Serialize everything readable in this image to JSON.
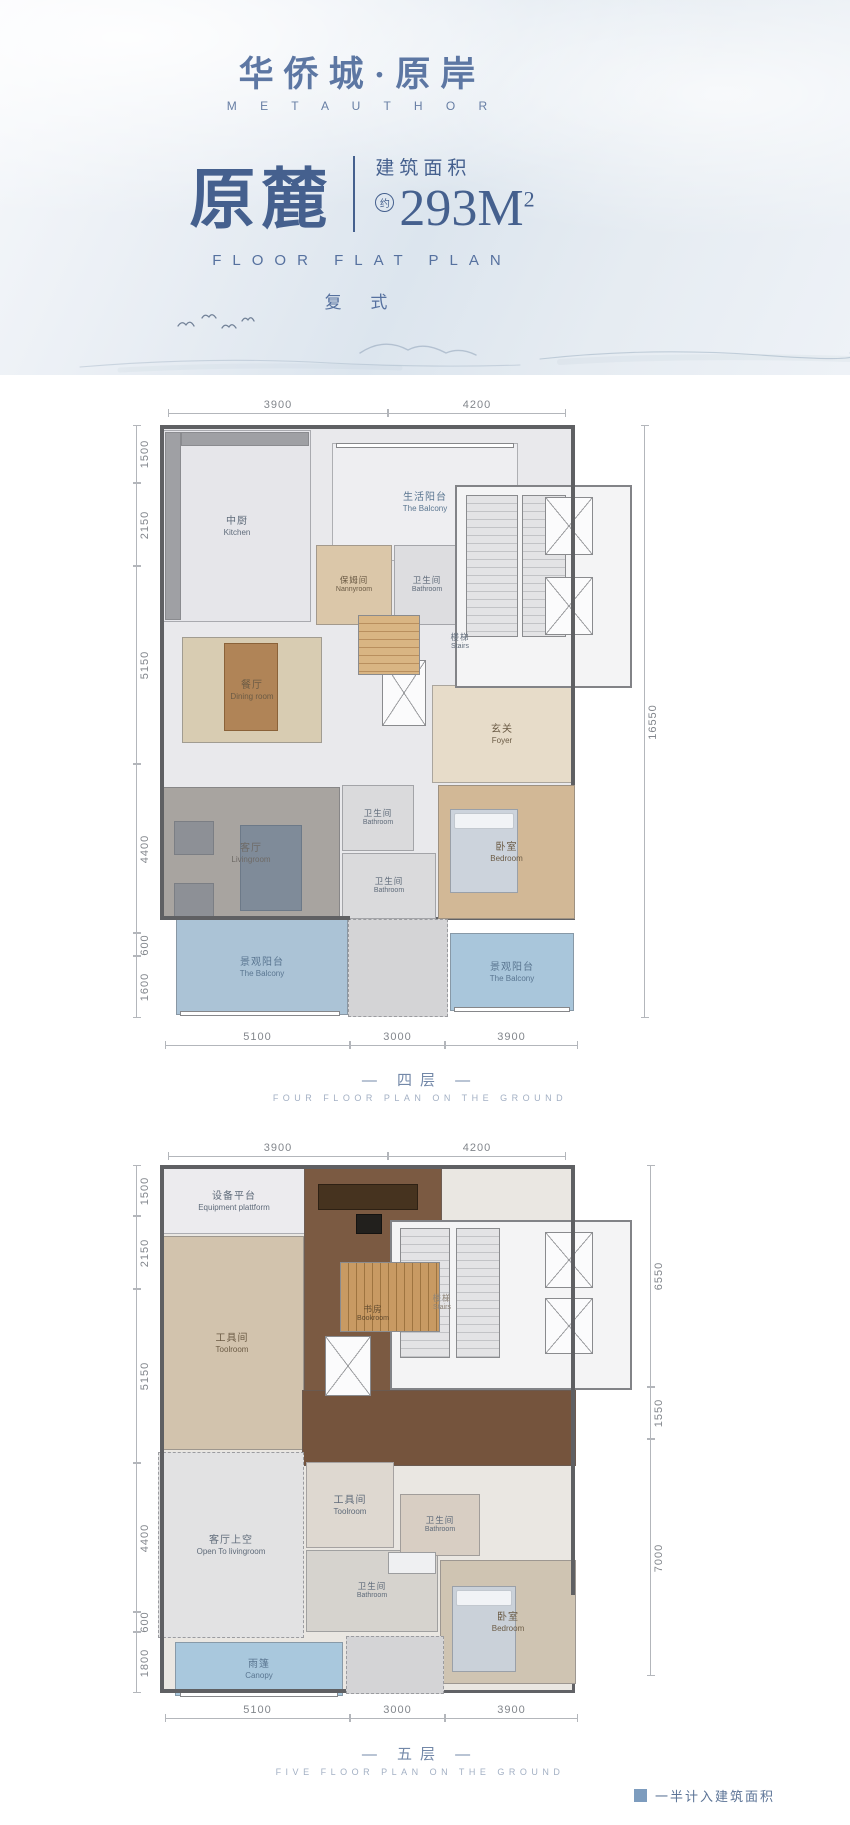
{
  "header": {
    "logo": "华侨城·原岸",
    "brand": "M E T A U T H O R",
    "title": "原麓",
    "area_label": "建筑面积",
    "area_approx": "约",
    "area_value": "293M",
    "area_sup": "2",
    "subtitle_en": "FLOOR FLAT PLAN",
    "type_label": "复 式"
  },
  "legend": {
    "text": "一半计入建筑面积"
  },
  "plans": [
    {
      "caption_cn": "— 四层 —",
      "caption_en": "FOUR FLOOR PLAN ON THE GROUND",
      "rooms": [
        {
          "id": "unit-floor",
          "x": 40,
          "y": 40,
          "w": 415,
          "h": 495,
          "bg": "#e9e9ec",
          "outer": true
        },
        {
          "id": "kitchen",
          "cn": "中厨",
          "en": "Kitchen",
          "x": 43,
          "y": 45,
          "w": 148,
          "h": 192,
          "bg": "#e6e6ea"
        },
        {
          "id": "life-balcony",
          "cn": "生活阳台",
          "en": "The Balcony",
          "x": 212,
          "y": 58,
          "w": 186,
          "h": 118,
          "bg": "#eeeef1",
          "lc": "#5a7691"
        },
        {
          "id": "nannyroom",
          "cn": "保姆间",
          "en": "Nannyroom",
          "x": 196,
          "y": 160,
          "w": 76,
          "h": 80,
          "bg": "#dbc7a9",
          "fs": "s",
          "lc": "#6b5b45"
        },
        {
          "id": "bathroom-1",
          "cn": "卫生间",
          "en": "Bathroom",
          "x": 274,
          "y": 160,
          "w": 66,
          "h": 80,
          "bg": "#dddde0",
          "fs": "s"
        },
        {
          "id": "stairs-area",
          "cn": "楼梯",
          "en": "Stairs",
          "x": 312,
          "y": 244,
          "w": 56,
          "h": 26,
          "fs": "s"
        },
        {
          "id": "dining-room",
          "cn": "餐厅",
          "en": "Dining room",
          "x": 62,
          "y": 252,
          "w": 140,
          "h": 106,
          "bg": "#d8ccb2",
          "lc": "#6b5b45"
        },
        {
          "id": "foyer",
          "cn": "玄关",
          "en": "Foyer",
          "x": 312,
          "y": 300,
          "w": 140,
          "h": 98,
          "bg": "#e7dcc9",
          "lc": "#6b5b45"
        },
        {
          "id": "bathroom-2",
          "cn": "卫生间",
          "en": "Bathroom",
          "x": 222,
          "y": 400,
          "w": 72,
          "h": 66,
          "bg": "#dadadc",
          "fs": "s"
        },
        {
          "id": "bathroom-3",
          "cn": "卫生间",
          "en": "Bathroom",
          "x": 222,
          "y": 468,
          "w": 94,
          "h": 66,
          "bg": "#dadadc",
          "fs": "s"
        },
        {
          "id": "livingroom",
          "cn": "客厅",
          "en": "Livingroom",
          "x": 42,
          "y": 402,
          "w": 178,
          "h": 132,
          "bg": "#a8a4a0",
          "lc": "#6e6a66"
        },
        {
          "id": "bedroom",
          "cn": "卧室",
          "en": "Bedroom",
          "x": 318,
          "y": 400,
          "w": 137,
          "h": 134,
          "bg": "#d2b896",
          "lc": "#6b5b45"
        },
        {
          "id": "terrace-mid",
          "x": 228,
          "y": 534,
          "w": 100,
          "h": 98,
          "bg": "#d4d4d6",
          "dashed": true
        },
        {
          "id": "view-balcony-left",
          "cn": "景观阳台",
          "en": "The Balcony",
          "x": 56,
          "y": 534,
          "w": 172,
          "h": 96,
          "bg": "#abc3d6",
          "lc": "#5a7691"
        },
        {
          "id": "view-balcony-right",
          "cn": "景观阳台",
          "en": "The Balcony",
          "x": 330,
          "y": 548,
          "w": 124,
          "h": 78,
          "bg": "#a9c6db",
          "lc": "#5a7691"
        }
      ],
      "features": [
        {
          "type": "core",
          "x": 335,
          "y": 100,
          "w": 177,
          "h": 203
        },
        {
          "type": "stripes",
          "dir": "h",
          "x": 346,
          "y": 110,
          "w": 52,
          "h": 142,
          "c1": "#e3e3e5",
          "c2": "#c2c3c6"
        },
        {
          "type": "stripes",
          "dir": "h",
          "x": 402,
          "y": 110,
          "w": 44,
          "h": 142,
          "c1": "#e3e3e5",
          "c2": "#c2c3c6"
        },
        {
          "type": "xbox",
          "x": 425,
          "y": 112,
          "w": 48,
          "h": 58
        },
        {
          "type": "xbox",
          "x": 425,
          "y": 192,
          "w": 48,
          "h": 58
        },
        {
          "type": "xbox",
          "x": 262,
          "y": 275,
          "w": 44,
          "h": 66
        },
        {
          "type": "stripes",
          "dir": "h",
          "x": 238,
          "y": 230,
          "w": 62,
          "h": 60,
          "c1": "#d9b583",
          "c2": "#b98f5e"
        },
        {
          "type": "block",
          "x": 104,
          "y": 258,
          "w": 54,
          "h": 88,
          "c": "#b08457",
          "br": "#8a6239"
        },
        {
          "type": "block",
          "x": 120,
          "y": 440,
          "w": 62,
          "h": 86,
          "c": "#7f8b99",
          "br": "#6c7988"
        },
        {
          "type": "block",
          "x": 54,
          "y": 436,
          "w": 40,
          "h": 34,
          "c": "#8d9096",
          "br": "#7b7e84"
        },
        {
          "type": "block",
          "x": 54,
          "y": 498,
          "w": 40,
          "h": 34,
          "c": "#8d9096",
          "br": "#7b7e84"
        },
        {
          "type": "bed",
          "x": 330,
          "y": 424,
          "w": 68,
          "h": 84,
          "c": "#ccd3dc"
        },
        {
          "type": "block",
          "x": 45,
          "y": 47,
          "w": 16,
          "h": 188,
          "c": "#9fa0a4",
          "br": "#8a8b8f"
        },
        {
          "type": "block",
          "x": 61,
          "y": 47,
          "w": 128,
          "h": 14,
          "c": "#9fa0a4",
          "br": "#8a8b8f"
        },
        {
          "type": "window",
          "x": 60,
          "y": 626,
          "w": 160,
          "h": 5
        },
        {
          "type": "window",
          "x": 334,
          "y": 622,
          "w": 116,
          "h": 5
        },
        {
          "type": "window",
          "x": 216,
          "y": 58,
          "w": 178,
          "h": 5
        },
        {
          "type": "wall",
          "x": 40,
          "y": 40,
          "w": 415,
          "h": 4
        },
        {
          "type": "wall",
          "x": 40,
          "y": 40,
          "w": 4,
          "h": 495
        },
        {
          "type": "wall",
          "x": 451,
          "y": 40,
          "w": 4,
          "h": 360
        },
        {
          "type": "wall",
          "x": 40,
          "y": 531,
          "w": 190,
          "h": 4
        }
      ],
      "dims": {
        "top": [
          {
            "t": "3900",
            "x1": 48,
            "x2": 268,
            "y": 12
          },
          {
            "t": "4200",
            "x1": 268,
            "x2": 446,
            "y": 12
          }
        ],
        "bottom": [
          {
            "t": "5100",
            "x1": 45,
            "x2": 230,
            "y": 644
          },
          {
            "t": "3000",
            "x1": 230,
            "x2": 325,
            "y": 644
          },
          {
            "t": "3900",
            "x1": 325,
            "x2": 458,
            "y": 644
          }
        ],
        "left": [
          {
            "t": "1500",
            "y1": 40,
            "y2": 98,
            "x": 16
          },
          {
            "t": "2150",
            "y1": 98,
            "y2": 181,
            "x": 16
          },
          {
            "t": "5150",
            "y1": 181,
            "y2": 379,
            "x": 16
          },
          {
            "t": "4400",
            "y1": 379,
            "y2": 548,
            "x": 16
          },
          {
            "t": "600",
            "y1": 548,
            "y2": 571,
            "x": 16
          },
          {
            "t": "1600",
            "y1": 571,
            "y2": 633,
            "x": 16
          }
        ],
        "right": [
          {
            "t": "16550",
            "y1": 40,
            "y2": 633,
            "x": 524
          }
        ]
      }
    },
    {
      "caption_cn": "— 五层 —",
      "caption_en": "FIVE FLOOR PLAN ON THE GROUND",
      "rooms": [
        {
          "id": "unit-floor",
          "x": 40,
          "y": 35,
          "w": 415,
          "h": 528,
          "bg": "#eae7e2",
          "outer": true
        },
        {
          "id": "equipment-platform",
          "cn": "设备平台",
          "en": "Equipment plattform",
          "x": 40,
          "y": 38,
          "w": 148,
          "h": 66,
          "bg": "#ecebee"
        },
        {
          "id": "toolroom-left",
          "cn": "工具间",
          "en": "Toolroom",
          "x": 40,
          "y": 106,
          "w": 144,
          "h": 214,
          "bg": "#d2c3ad",
          "planks": true,
          "lc": "#6b5b45"
        },
        {
          "id": "bookroom",
          "cn": "书房",
          "en": "Bookroom",
          "x": 184,
          "y": 38,
          "w": 138,
          "h": 292,
          "bg": "#7b5a42",
          "lc": "rgba(40,30,18,0.65)",
          "fs": "s"
        },
        {
          "id": "stairs-area",
          "cn": "楼梯",
          "en": "Stairs",
          "x": 292,
          "y": 160,
          "w": 60,
          "h": 26,
          "fs": "s",
          "lc": "#8f8578"
        },
        {
          "id": "hallway",
          "x": 182,
          "y": 260,
          "w": 274,
          "h": 76,
          "bg": "#75543d"
        },
        {
          "id": "open-to-livingroom",
          "cn": "客厅上空",
          "en": "Open To livingroom",
          "x": 38,
          "y": 322,
          "w": 146,
          "h": 186,
          "bg": "#e2e2e3",
          "dashed": true
        },
        {
          "id": "toolroom-mid",
          "cn": "工具间",
          "en": "Toolroom",
          "x": 186,
          "y": 332,
          "w": 88,
          "h": 86,
          "bg": "#ded8d0"
        },
        {
          "id": "bathroom-mid",
          "cn": "卫生间",
          "en": "Bathroom",
          "x": 186,
          "y": 420,
          "w": 132,
          "h": 82,
          "bg": "#d6d3ce",
          "fs": "s"
        },
        {
          "id": "bathroom-right",
          "cn": "卫生间",
          "en": "Bathroom",
          "x": 280,
          "y": 364,
          "w": 80,
          "h": 62,
          "bg": "#d8cec3",
          "fs": "s"
        },
        {
          "id": "bedroom",
          "cn": "卧室",
          "en": "Bedroom",
          "x": 320,
          "y": 430,
          "w": 136,
          "h": 124,
          "bg": "#cfc4b2",
          "lc": "#6b5b45"
        },
        {
          "id": "terrace-mid",
          "x": 226,
          "y": 506,
          "w": 98,
          "h": 58,
          "bg": "#d4d4d6",
          "dashed": true
        },
        {
          "id": "canopy",
          "cn": "雨篷",
          "en": "Canopy",
          "x": 55,
          "y": 512,
          "w": 168,
          "h": 54,
          "bg": "#a9c8dd",
          "lc": "#5a7691"
        }
      ],
      "features": [
        {
          "type": "core",
          "x": 270,
          "y": 90,
          "w": 242,
          "h": 170
        },
        {
          "type": "stripes",
          "dir": "h",
          "x": 280,
          "y": 98,
          "w": 50,
          "h": 130,
          "c1": "#e3e3e5",
          "c2": "#c2c3c6"
        },
        {
          "type": "stripes",
          "dir": "h",
          "x": 336,
          "y": 98,
          "w": 44,
          "h": 130,
          "c1": "#e3e3e5",
          "c2": "#c2c3c6"
        },
        {
          "type": "xbox",
          "x": 425,
          "y": 102,
          "w": 48,
          "h": 56
        },
        {
          "type": "xbox",
          "x": 425,
          "y": 168,
          "w": 48,
          "h": 56
        },
        {
          "type": "stripes",
          "dir": "v",
          "x": 220,
          "y": 132,
          "w": 100,
          "h": 70,
          "c1": "#c89a63",
          "c2": "#9e7440"
        },
        {
          "type": "xbox",
          "x": 205,
          "y": 206,
          "w": 46,
          "h": 60
        },
        {
          "type": "block",
          "x": 198,
          "y": 54,
          "w": 100,
          "h": 26,
          "c": "#46331f",
          "br": "#2e2114"
        },
        {
          "type": "block",
          "x": 236,
          "y": 84,
          "w": 26,
          "h": 20,
          "c": "#22201d",
          "br": "#141311"
        },
        {
          "type": "bed",
          "x": 332,
          "y": 456,
          "w": 64,
          "h": 86,
          "c": "#cad1d9"
        },
        {
          "type": "block",
          "x": 268,
          "y": 422,
          "w": 48,
          "h": 22,
          "c": "#eff0f2",
          "br": "#9c9d9f"
        },
        {
          "type": "window",
          "x": 60,
          "y": 562,
          "w": 158,
          "h": 5
        },
        {
          "type": "wall",
          "x": 40,
          "y": 35,
          "w": 415,
          "h": 4
        },
        {
          "type": "wall",
          "x": 40,
          "y": 35,
          "w": 4,
          "h": 528
        },
        {
          "type": "wall",
          "x": 451,
          "y": 35,
          "w": 4,
          "h": 430
        },
        {
          "type": "wall",
          "x": 40,
          "y": 559,
          "w": 186,
          "h": 4
        }
      ],
      "dims": {
        "top": [
          {
            "t": "3900",
            "x1": 48,
            "x2": 268,
            "y": 10
          },
          {
            "t": "4200",
            "x1": 268,
            "x2": 446,
            "y": 10
          }
        ],
        "bottom": [
          {
            "t": "5100",
            "x1": 45,
            "x2": 230,
            "y": 572
          },
          {
            "t": "3000",
            "x1": 230,
            "x2": 325,
            "y": 572
          },
          {
            "t": "3900",
            "x1": 325,
            "x2": 458,
            "y": 572
          }
        ],
        "left": [
          {
            "t": "1500",
            "y1": 35,
            "y2": 86,
            "x": 16
          },
          {
            "t": "2150",
            "y1": 86,
            "y2": 159,
            "x": 16
          },
          {
            "t": "5150",
            "y1": 159,
            "y2": 333,
            "x": 16
          },
          {
            "t": "4400",
            "y1": 333,
            "y2": 482,
            "x": 16
          },
          {
            "t": "600",
            "y1": 482,
            "y2": 502,
            "x": 16
          },
          {
            "t": "1800",
            "y1": 502,
            "y2": 563,
            "x": 16
          }
        ],
        "right": [
          {
            "t": "6550",
            "y1": 35,
            "y2": 257,
            "x": 530
          },
          {
            "t": "1550",
            "y1": 257,
            "y2": 309,
            "x": 530
          },
          {
            "t": "7000",
            "y1": 309,
            "y2": 546,
            "x": 530
          }
        ]
      }
    }
  ]
}
